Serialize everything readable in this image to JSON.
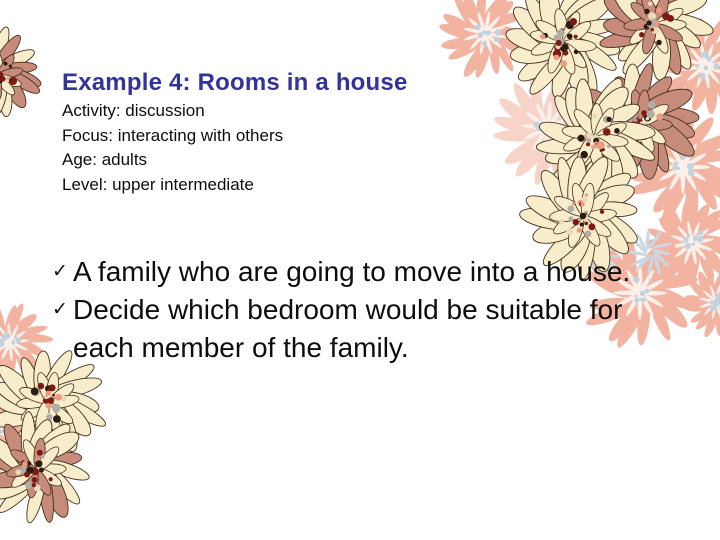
{
  "slide": {
    "title": "Example 4: Rooms in a house",
    "details": [
      "Activity: discussion",
      "Focus: interacting with others",
      "Age: adults",
      "Level: upper intermediate"
    ],
    "bullet_marker": "✓",
    "bullets": [
      {
        "lines": [
          "A family who are going to move into a house."
        ]
      },
      {
        "lines": [
          "Decide which bedroom would be suitable for",
          "each member of the family."
        ]
      }
    ]
  },
  "colors": {
    "background": "#ffffff",
    "title_text": "#333399",
    "body_text": "#0d0d0d",
    "petal_cream": "#F8EDCB",
    "petal_rose": "#C68B7B",
    "petal_faded_pink": "#F3B3A1",
    "petal_pale_pink": "#F8D3C8",
    "petal_blue_gray": "#C9D8E3",
    "petal_outline": "#44301d",
    "streak_light": "#FBEFE9",
    "dot_dark_red": "#7E1A14",
    "dot_black": "#2B1B10",
    "dot_gray": "#B3ACA5",
    "dot_salmon": "#F0997F",
    "dot_cream": "#E8D9B8",
    "dot_blue": "#C2D2DE"
  }
}
